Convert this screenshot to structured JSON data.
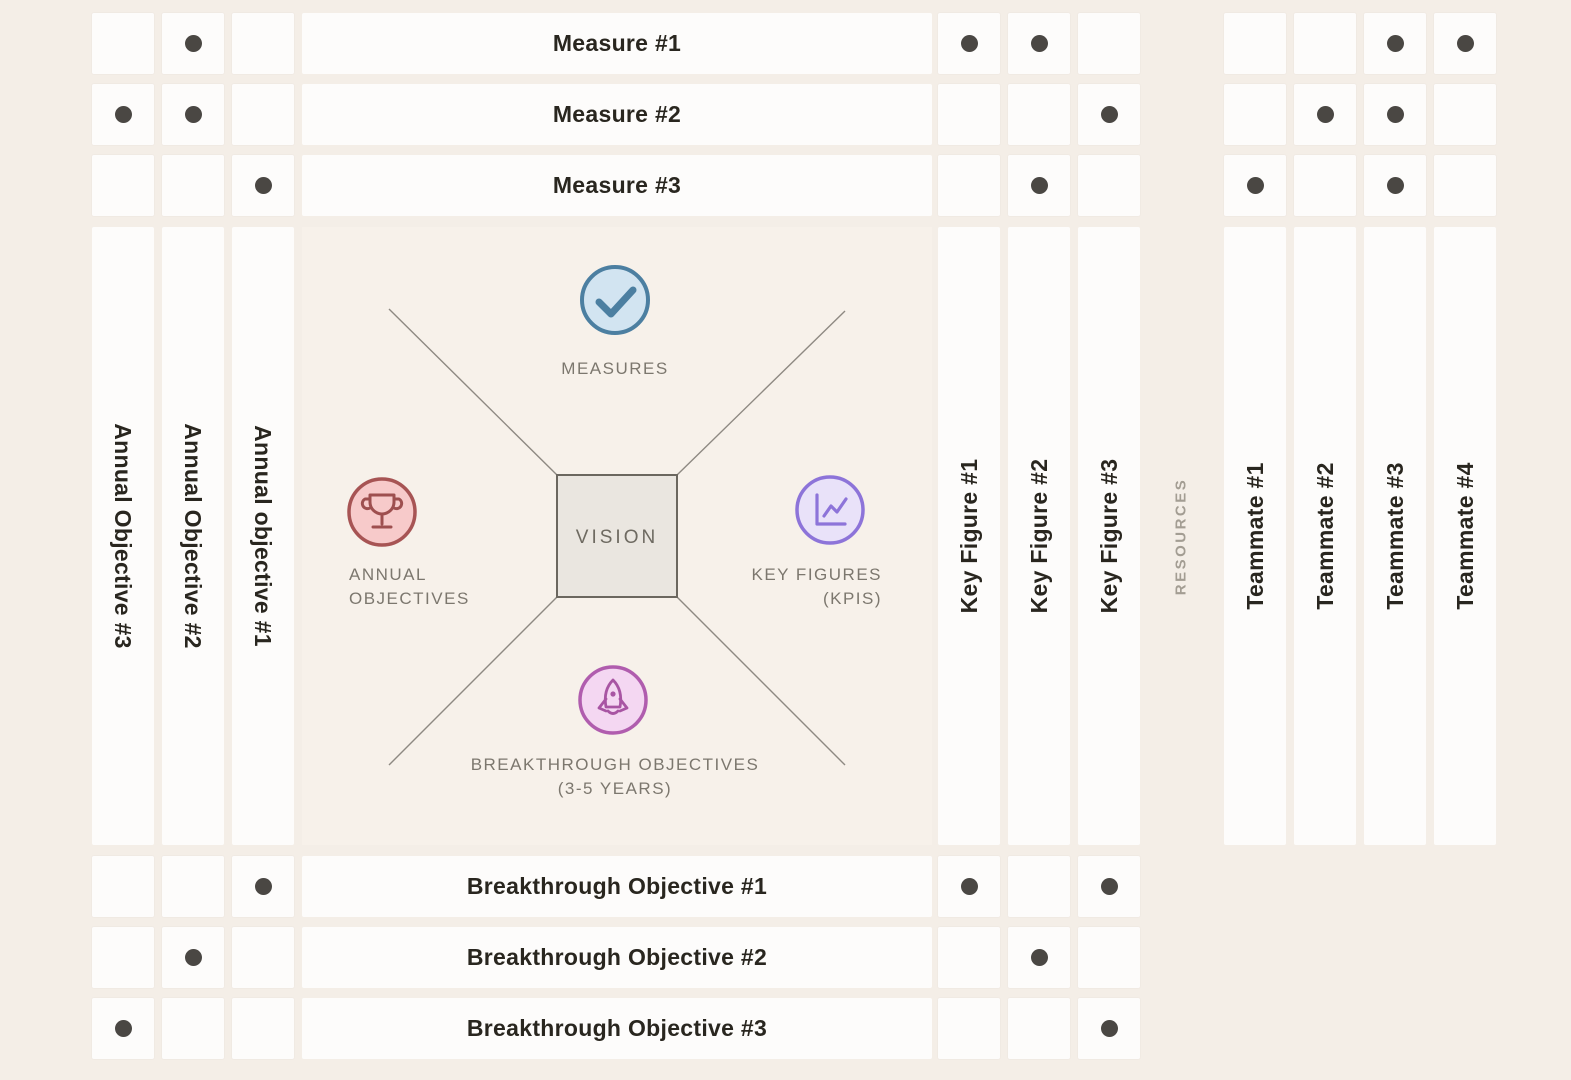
{
  "page": {
    "background_color": "#f4eee7",
    "panel_color": "#f7f1ea",
    "cell_color": "#fdfcfb",
    "dot_color": "#4a4743"
  },
  "columns": {
    "annual_objectives": [
      "Annual Objective #3",
      "Annual Objective #2",
      "Annual objective #1"
    ],
    "key_figures": [
      "Key Figure #1",
      "Key Figure #2",
      "Key Figure #3"
    ],
    "resources_label": "RESOURCES",
    "teammates": [
      "Teammate #1",
      "Teammate #2",
      "Teammate #3",
      "Teammate #4"
    ]
  },
  "measures": {
    "rows": [
      {
        "label": "Measure #1",
        "annual_dots": [
          0,
          1,
          0
        ],
        "key_figure_dots": [
          1,
          1,
          0
        ],
        "teammate_dots": [
          0,
          0,
          1,
          1
        ]
      },
      {
        "label": "Measure #2",
        "annual_dots": [
          1,
          1,
          0
        ],
        "key_figure_dots": [
          0,
          0,
          1
        ],
        "teammate_dots": [
          0,
          1,
          1,
          0
        ]
      },
      {
        "label": "Measure #3",
        "annual_dots": [
          0,
          0,
          1
        ],
        "key_figure_dots": [
          0,
          1,
          0
        ],
        "teammate_dots": [
          1,
          0,
          1,
          0
        ]
      }
    ]
  },
  "breakthroughs": {
    "rows": [
      {
        "label": "Breakthrough Objective #1",
        "annual_dots": [
          0,
          0,
          1
        ],
        "key_figure_dots": [
          1,
          0,
          1
        ]
      },
      {
        "label": "Breakthrough Objective #2",
        "annual_dots": [
          0,
          1,
          0
        ],
        "key_figure_dots": [
          0,
          1,
          0
        ]
      },
      {
        "label": "Breakthrough Objective #3",
        "annual_dots": [
          1,
          0,
          0
        ],
        "key_figure_dots": [
          0,
          0,
          1
        ]
      }
    ]
  },
  "center": {
    "vision_label": "VISION",
    "measures": {
      "label": "MEASURES",
      "icon": "check-icon",
      "circle_fill": "#d2e4f1",
      "accent": "#4c7fa1"
    },
    "annual_objectives": {
      "label_line1": "ANNUAL",
      "label_line2": "OBJECTIVES",
      "icon": "trophy-icon",
      "circle_fill": "#f7caca",
      "accent": "#a75454"
    },
    "key_figures": {
      "label_line1": "KEY FIGURES",
      "label_line2": "(KPIS)",
      "icon": "line-chart-icon",
      "circle_fill": "#e9e2f9",
      "accent": "#8d74d9"
    },
    "breakthrough_objectives": {
      "label_line1": "BREAKTHROUGH OBJECTIVES",
      "label_line2": "(3-5 YEARS)",
      "icon": "rocket-icon",
      "circle_fill": "#f4d7f2",
      "accent": "#b05dae"
    }
  }
}
